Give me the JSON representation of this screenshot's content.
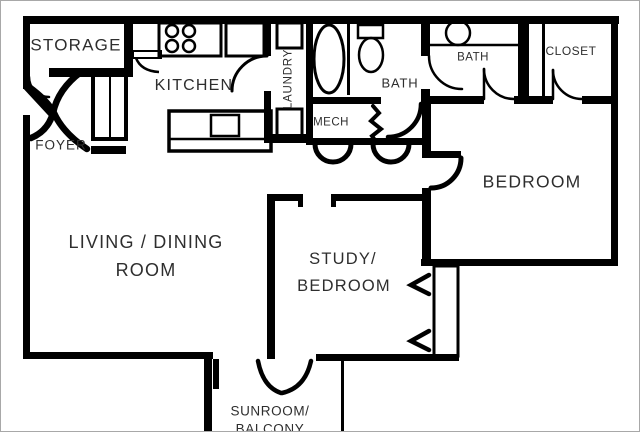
{
  "plan_title": "apartment-floor-plan",
  "rooms": {
    "storage": "STORAGE",
    "kitchen": "KITCHEN",
    "laundry": "LAUNDRY",
    "foyer": "FOYER",
    "mech": "MECH",
    "bath_main": "BATH",
    "bath_second": "BATH",
    "closet": "CLOSET",
    "bedroom": "BEDROOM",
    "living_line1": "LIVING / DINING",
    "living_line2": "ROOM",
    "study_line1": "STUDY/",
    "study_line2": "BEDROOM",
    "sunroom_line1": "SUNROOM/",
    "sunroom_line2": "BALCONY"
  },
  "fixtures": {
    "stove": "stove-with-four-burners",
    "counter": "kitchen-counter",
    "island": "kitchen-island-with-sink",
    "foyer_closet": "foyer-double-door-closet",
    "washer": "washer",
    "dryer": "dryer",
    "bathtub": "bathtub",
    "toilet": "toilet",
    "vanity_sink": "vanity-sink",
    "window_channel": "study-closet-wall",
    "french_doors": "french-doors-to-sunroom"
  },
  "colors": {
    "wall": "#000000",
    "text": "#2e2e2e",
    "background": "#ffffff",
    "frame": "#a8a8a8"
  }
}
